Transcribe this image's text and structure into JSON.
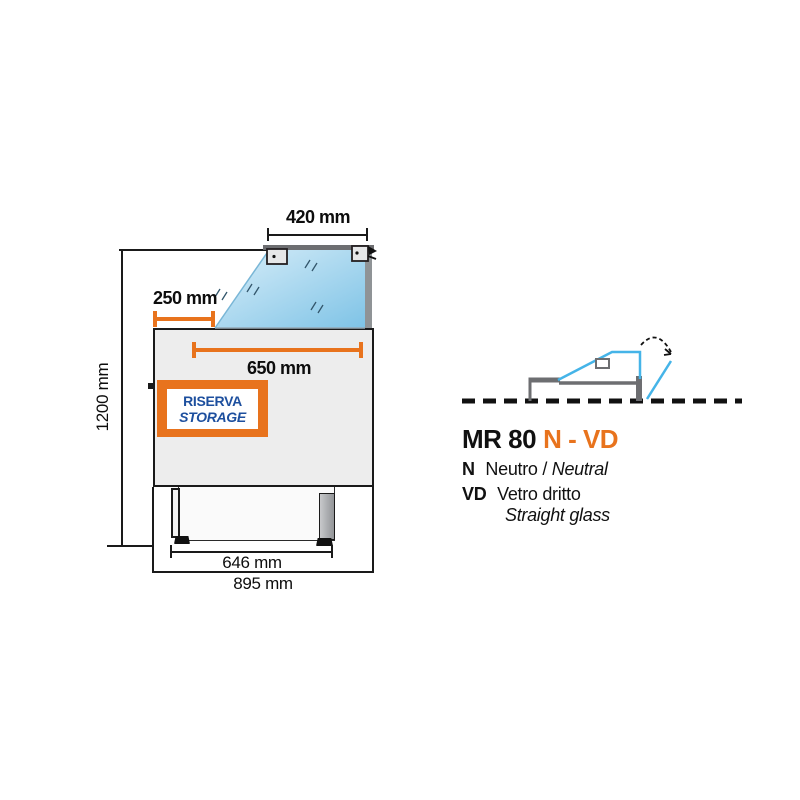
{
  "page": {
    "type": "technical-spec-diagram",
    "background": "#ffffff"
  },
  "drawing": {
    "dimensions": {
      "top_glass_width": "420 mm",
      "front_offset": "250 mm",
      "display_width": "650 mm",
      "total_height": "1200 mm",
      "feet_span": "646 mm",
      "total_depth": "895 mm"
    },
    "badge": {
      "line1": "RISERVA",
      "line2": "STORAGE"
    }
  },
  "legend": {
    "model": {
      "prefix": "MR 80",
      "suffix": "N - VD"
    },
    "entries": [
      {
        "code": "N",
        "label_it": "Neutro /",
        "label_en": "Neutral"
      },
      {
        "code": "VD",
        "label_it": "Vetro dritto",
        "label_en": "Straight glass"
      }
    ]
  },
  "colors": {
    "accent_orange": "#E8731D",
    "badge_blue": "#1D4F9E",
    "glass_light": "#D9EEF9",
    "glass_dark": "#7EC3E6",
    "outline_gray": "#6D6E71",
    "schematic_blue": "#45B4E8"
  }
}
